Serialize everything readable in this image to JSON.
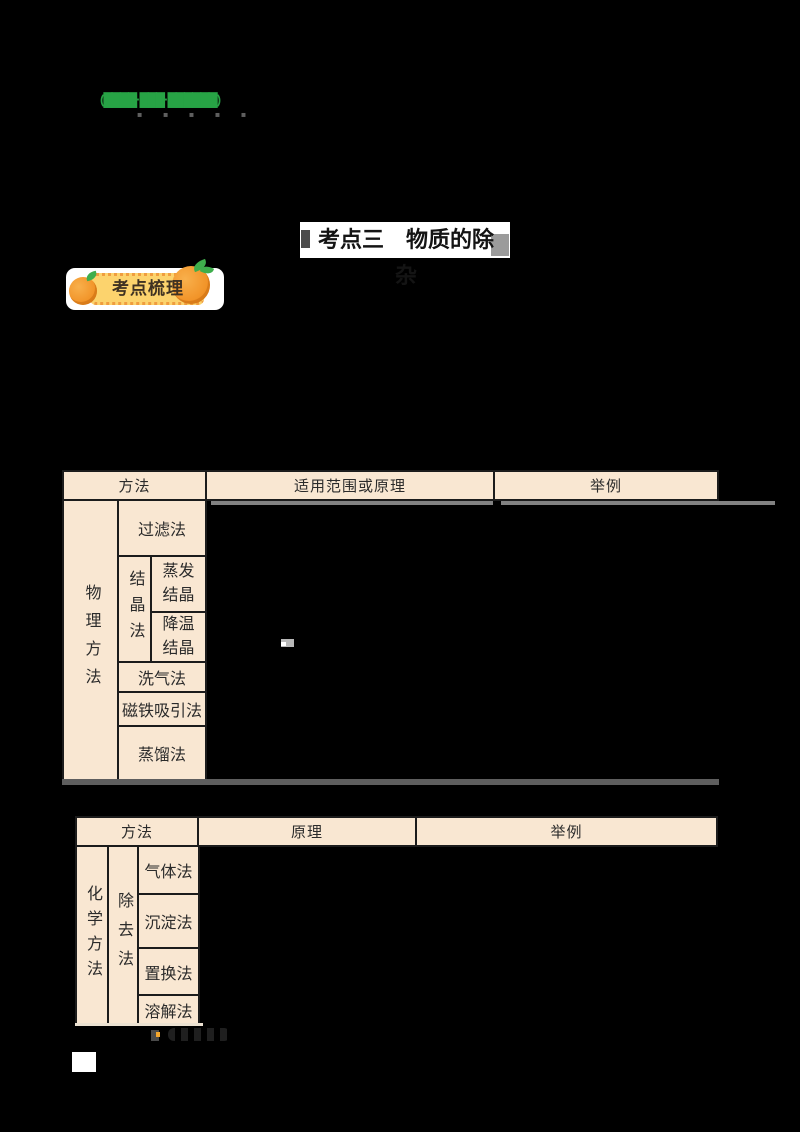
{
  "top": {
    "green_mark": "(████·███·██████)",
    "dot_marks": "▪ ▪ ▪ ▪ ▪"
  },
  "title": {
    "text": "考点三　物质的除杂"
  },
  "badge": {
    "label": "考点梳理"
  },
  "table_physical": {
    "headers": {
      "method": "方法",
      "scope": "适用范围或原理",
      "example": "举例"
    },
    "category": "物理方法",
    "rows": {
      "filtration": "过滤法",
      "crystallization_group": "结晶法",
      "evaporation": "蒸发结晶",
      "cooling": "降温结晶",
      "gas_washing": "洗气法",
      "magnet": "磁铁吸引法",
      "distillation": "蒸馏法"
    }
  },
  "table_chemical": {
    "headers": {
      "method": "方法",
      "principle": "原理",
      "example": "举例"
    },
    "category": "化学方法",
    "group": "除去法",
    "rows": {
      "gas": "气体法",
      "precipitation": "沉淀法",
      "displacement": "置换法",
      "dissolution": "溶解法"
    }
  },
  "colors": {
    "cell_bg": "#f9e7d2",
    "cell_border": "#1c1c1c",
    "badge_yellow": "#fcd36d",
    "badge_dash": "#ef9d3f",
    "orange_fruit": "#f2952a",
    "leaf_green": "#3fae4c",
    "green_text": "#27a345",
    "page_bg": "#000000"
  }
}
